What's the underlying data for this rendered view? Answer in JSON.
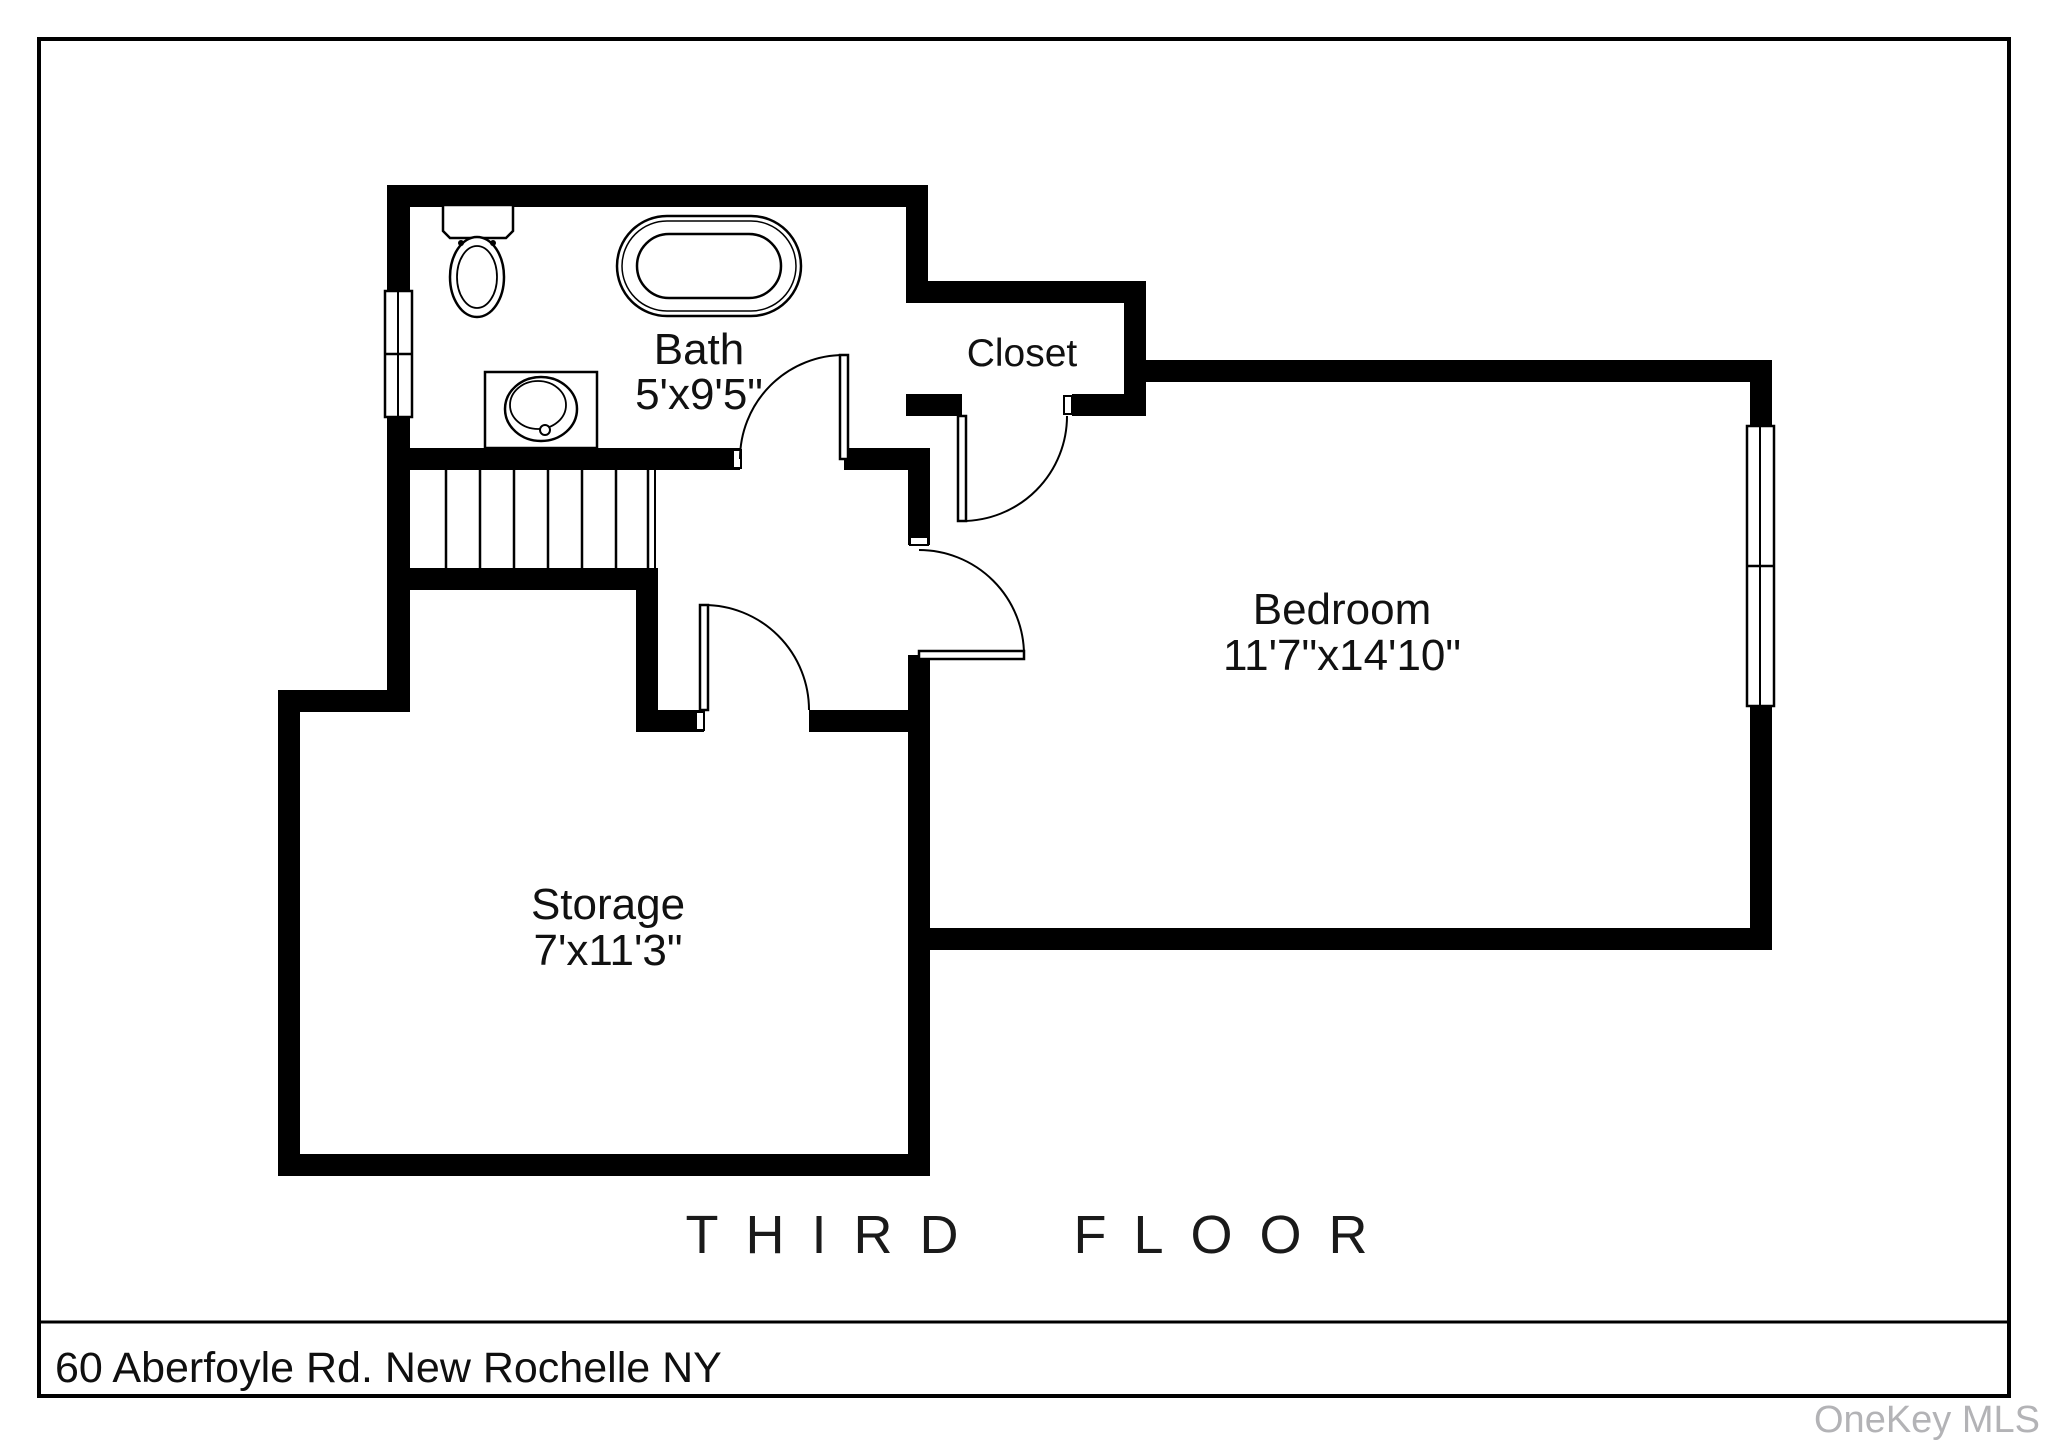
{
  "page": {
    "floor_title": "THIRD FLOOR",
    "address": "60 Aberfoyle Rd. New Rochelle NY",
    "watermark": "OneKey MLS"
  },
  "rooms": {
    "bath": {
      "name": "Bath",
      "dimensions": "5'x9'5\""
    },
    "closet": {
      "name": "Closet"
    },
    "bedroom": {
      "name": "Bedroom",
      "dimensions": "11'7\"x14'10\""
    },
    "storage": {
      "name": "Storage",
      "dimensions": "7'x11'3\""
    }
  },
  "fixtures": [
    "toilet",
    "bathtub",
    "sink",
    "stairs"
  ],
  "doors": [
    "bath-door",
    "closet-door",
    "bedroom-door",
    "storage-door"
  ],
  "windows": [
    "bath-window",
    "bedroom-window"
  ],
  "colors": {
    "walls": "#000000",
    "background": "#ffffff",
    "text": "#111111",
    "watermark": "#b3b3b6"
  }
}
